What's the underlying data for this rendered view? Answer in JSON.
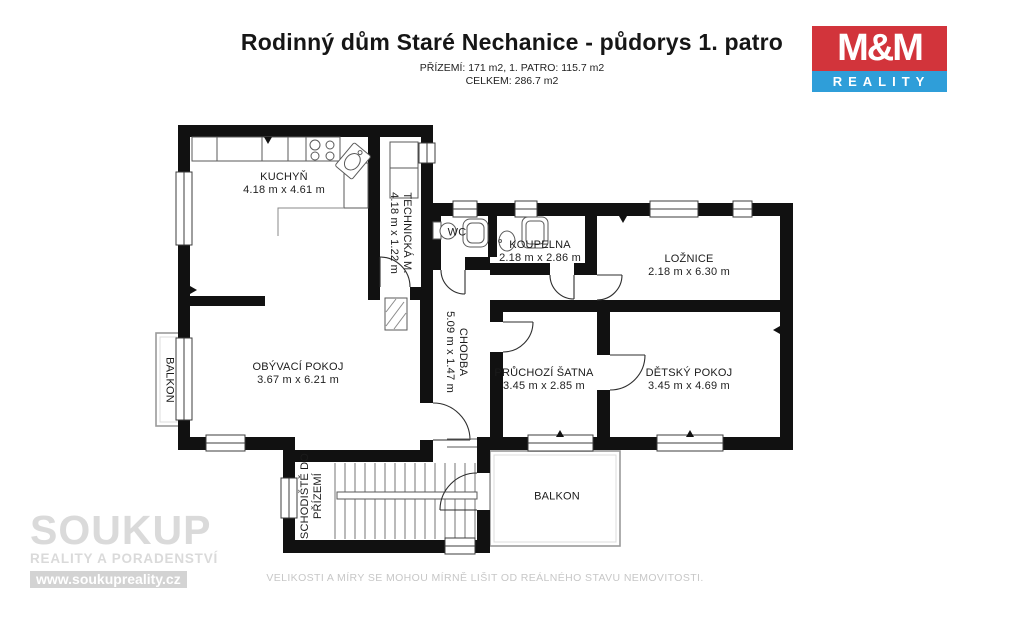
{
  "header": {
    "title": "Rodinný dům Staré Nechanice - půdorys 1. patro",
    "area_line1": "PŘÍZEMÍ: 171 m2, 1. PATRO: 115.7 m2",
    "area_line2": "CELKEM: 286.7 m2"
  },
  "logo": {
    "top_text": "M&M",
    "bottom_text": "REALITY"
  },
  "colors": {
    "wall": "#111111",
    "logo_red": "#d2343b",
    "logo_blue": "#2f9ed9",
    "watermark_gray": "#dadada"
  },
  "rooms": {
    "kuchyn": {
      "name": "KUCHYŇ",
      "dims": "4.18 m x 4.61 m"
    },
    "technicka": {
      "name": "TECHNICKÁ M.",
      "dims": "4.18 m x 1.22 m"
    },
    "wc": {
      "name": "WC"
    },
    "koupelna": {
      "name": "KOUPELNA",
      "dims": "2.18 m x 2.86 m"
    },
    "loznice": {
      "name": "LOŽNICE",
      "dims": "2.18 m x 6.30 m"
    },
    "obyvaci": {
      "name": "OBÝVACÍ POKOJ",
      "dims": "3.67 m x 6.21 m"
    },
    "chodba": {
      "name": "CHODBA",
      "dims": "5.09 m x 1.47 m"
    },
    "satna": {
      "name": "PRŮCHOZÍ ŠATNA",
      "dims": "3.45 m x 2.85 m"
    },
    "detsky": {
      "name": "DĚTSKÝ POKOJ",
      "dims": "3.45 m x 4.69 m"
    },
    "schodiste": {
      "line1": "SCHODIŠTĚ DO",
      "line2": "PŘÍZEMÍ"
    },
    "balkon_left": {
      "name": "BALKON"
    },
    "balkon_bottom": {
      "name": "BALKON"
    }
  },
  "watermark": {
    "brand": "SOUKUP",
    "tagline": "REALITY A PORADENSTVÍ",
    "url": "www.soukupreality.cz"
  },
  "footer": {
    "disclaimer": "VELIKOSTI A MÍRY SE MOHOU MÍRNĚ LIŠIT OD REÁLNÉHO STAVU NEMOVITOSTI."
  }
}
